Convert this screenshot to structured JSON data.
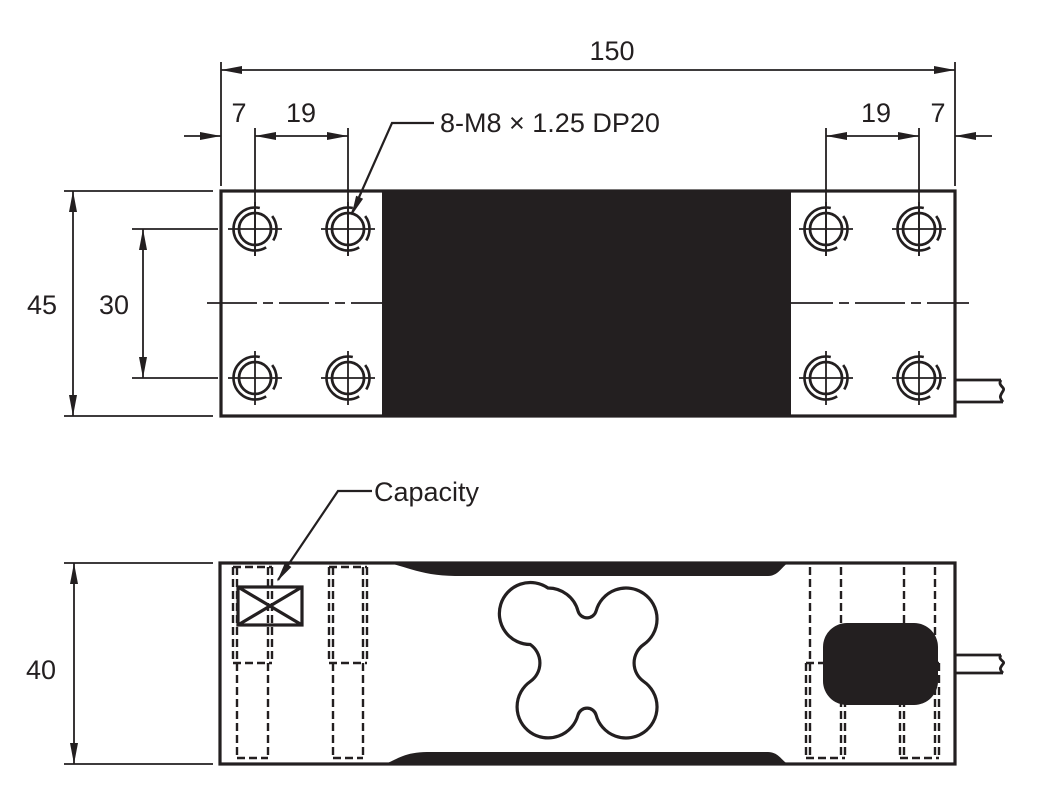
{
  "colors": {
    "ink": "#231f20",
    "paper": "#ffffff"
  },
  "top_view": {
    "overall_width": "150",
    "left_edge_offset": "7",
    "left_hole_pitch": "19",
    "right_hole_pitch": "19",
    "right_edge_offset": "7",
    "overall_depth": "45",
    "hole_row_pitch": "30",
    "thread_callout": "8-M8 × 1.25 DP20"
  },
  "side_view": {
    "overall_height": "40",
    "capacity_label": "Capacity"
  }
}
